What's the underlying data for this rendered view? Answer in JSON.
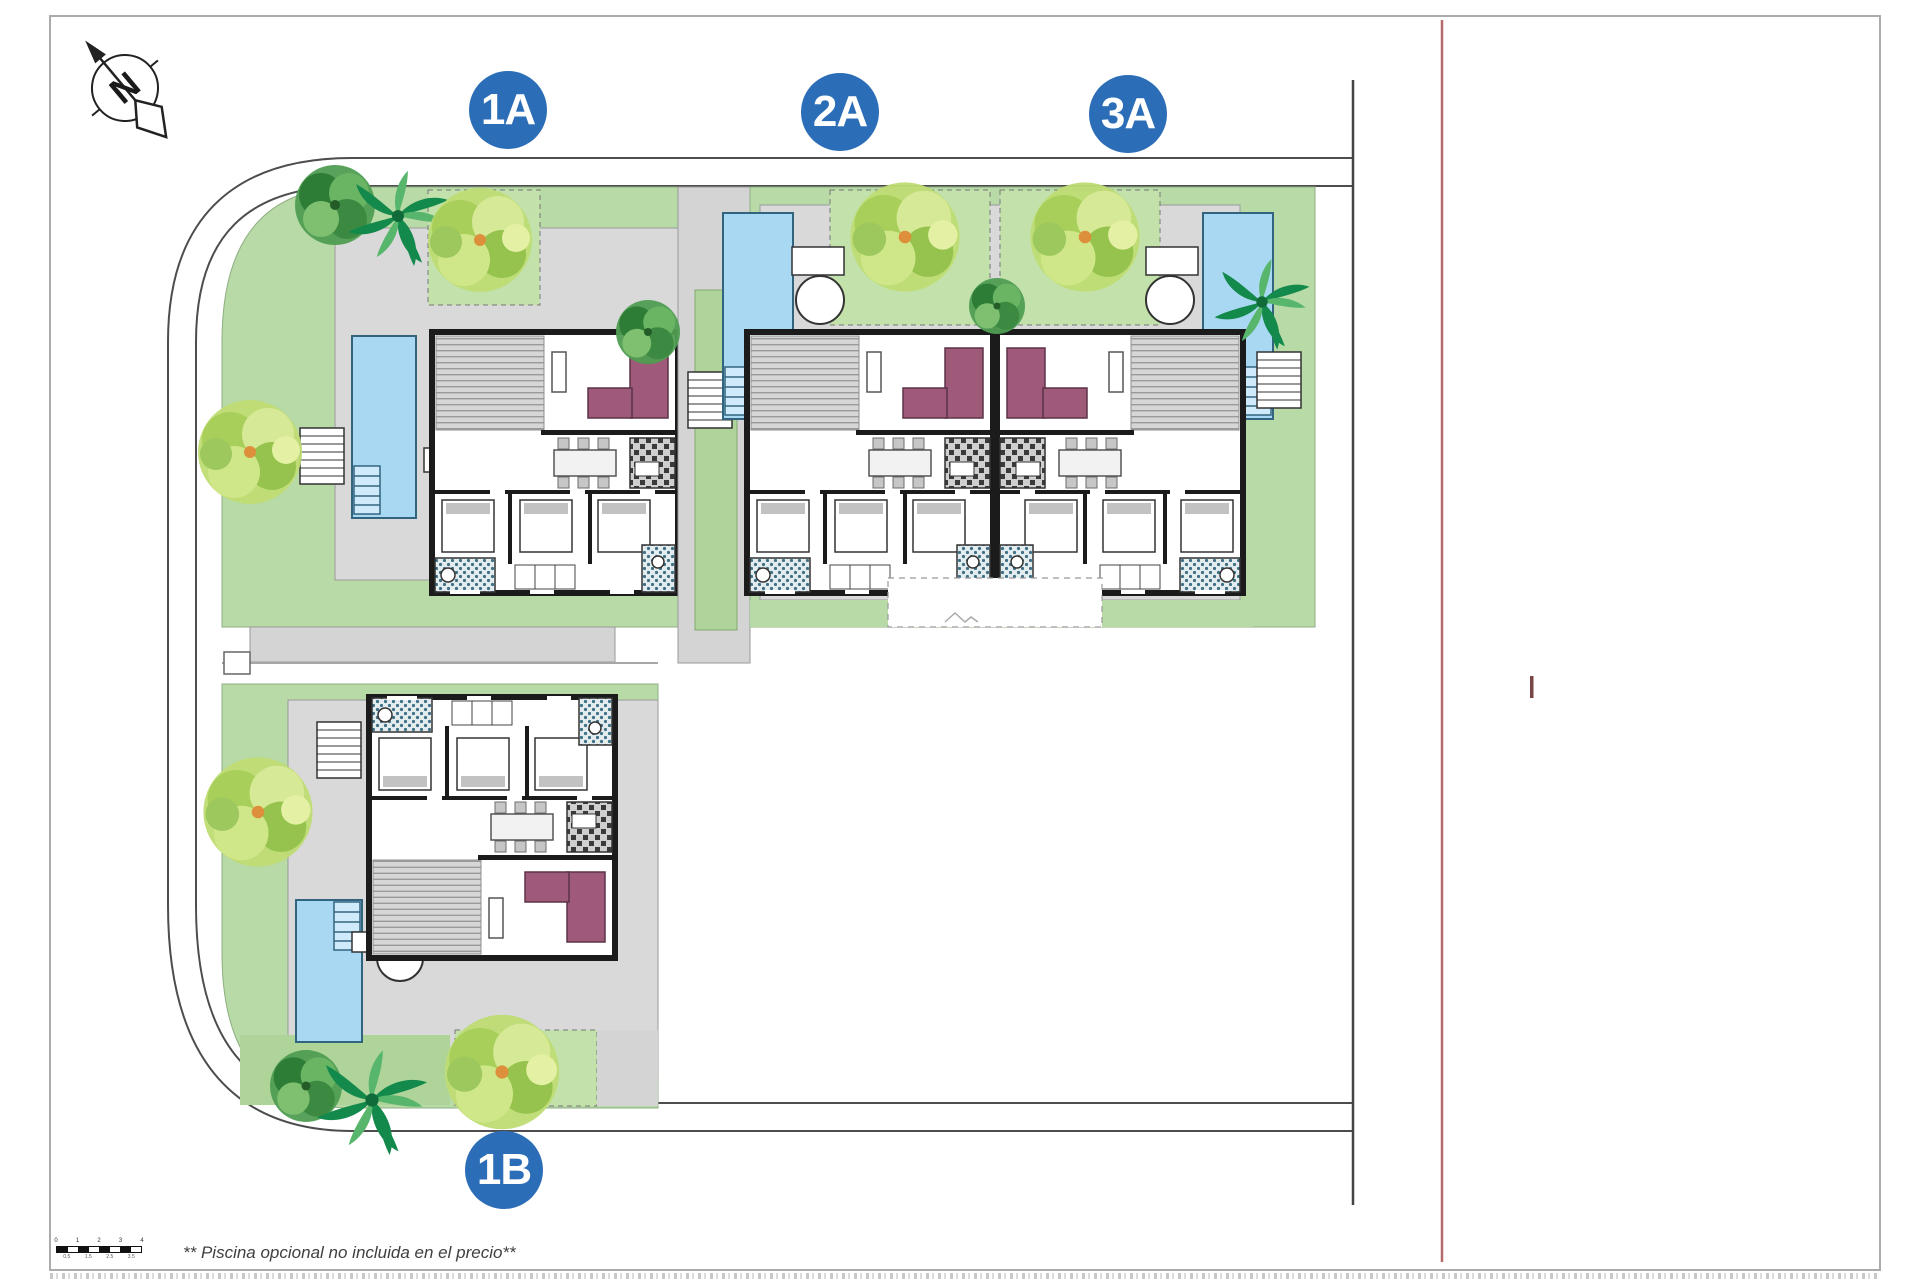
{
  "compass": {
    "letter": "N"
  },
  "villas": [
    {
      "id": "1a",
      "label": "1A"
    },
    {
      "id": "2a",
      "label": "2A"
    },
    {
      "id": "3a",
      "label": "3A"
    },
    {
      "id": "1b",
      "label": "1B"
    }
  ],
  "note": "** Piscina opcional no incluida en el precio**",
  "scale_bar": {
    "top_labels": [
      "0",
      "1",
      "2",
      "3",
      "4"
    ],
    "bottom_labels": [
      "0.5",
      "1.5",
      "2.5",
      "3.5"
    ]
  },
  "colors": {
    "badge_blue": "#2b6db6",
    "garden_green": "#b7daa6",
    "bright_garden_green": "#c3e2ab",
    "paving_gray": "#d9d9d9",
    "pool_blue": "#a9d9f2",
    "pool_edge": "#33647f",
    "sofa_purple": "#9e5a78",
    "road_line": "#4d4d4d",
    "wall_black": "#1b1b1b",
    "red_reference": "#b36b6b",
    "bath_tile_teal": "#3f7086"
  }
}
